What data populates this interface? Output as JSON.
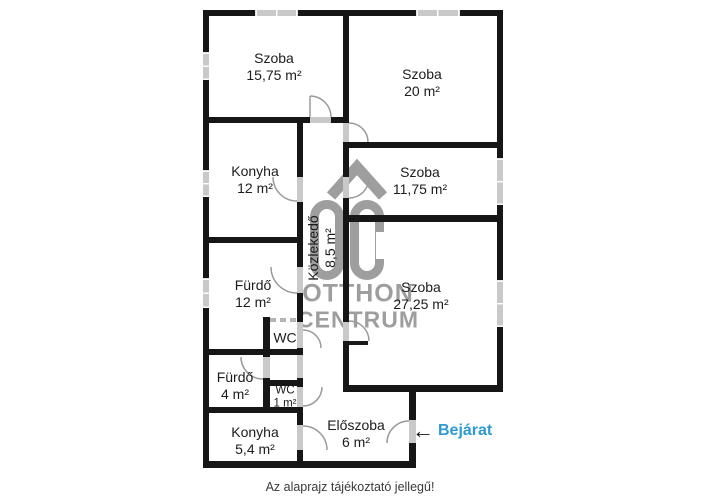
{
  "floorplan": {
    "rooms": [
      {
        "name": "Szoba",
        "area": "15,75 m²"
      },
      {
        "name": "Szoba",
        "area": "20 m²"
      },
      {
        "name": "Konyha",
        "area": "12 m²"
      },
      {
        "name": "Szoba",
        "area": "11,75 m²"
      },
      {
        "name": "Közlekedő",
        "area": "8,5 m²"
      },
      {
        "name": "Fürdő",
        "area": "12 m²"
      },
      {
        "name": "WC",
        "area": ""
      },
      {
        "name": "Szoba",
        "area": "27,25 m²"
      },
      {
        "name": "Fürdő",
        "area": "4 m²"
      },
      {
        "name": "WC",
        "area": "1 m²"
      },
      {
        "name": "Konyha",
        "area": "5,4 m²"
      },
      {
        "name": "Előszoba",
        "area": "6 m²"
      }
    ],
    "entrance_label": "Bejárat",
    "disclaimer": "Az alaprajz tájékoztató jellegű!",
    "watermark": {
      "monogram": "OC",
      "line1": "OTTHON",
      "line2": "CENTRUM"
    },
    "icons": {
      "entrance_arrow": "←"
    },
    "colors": {
      "wall": "#161616",
      "window_gray": "#c9c9c9",
      "door_arc": "#9a9a9a",
      "entrance_blue": "#2d9ad3",
      "watermark_gray": "#9e9e9e"
    }
  }
}
